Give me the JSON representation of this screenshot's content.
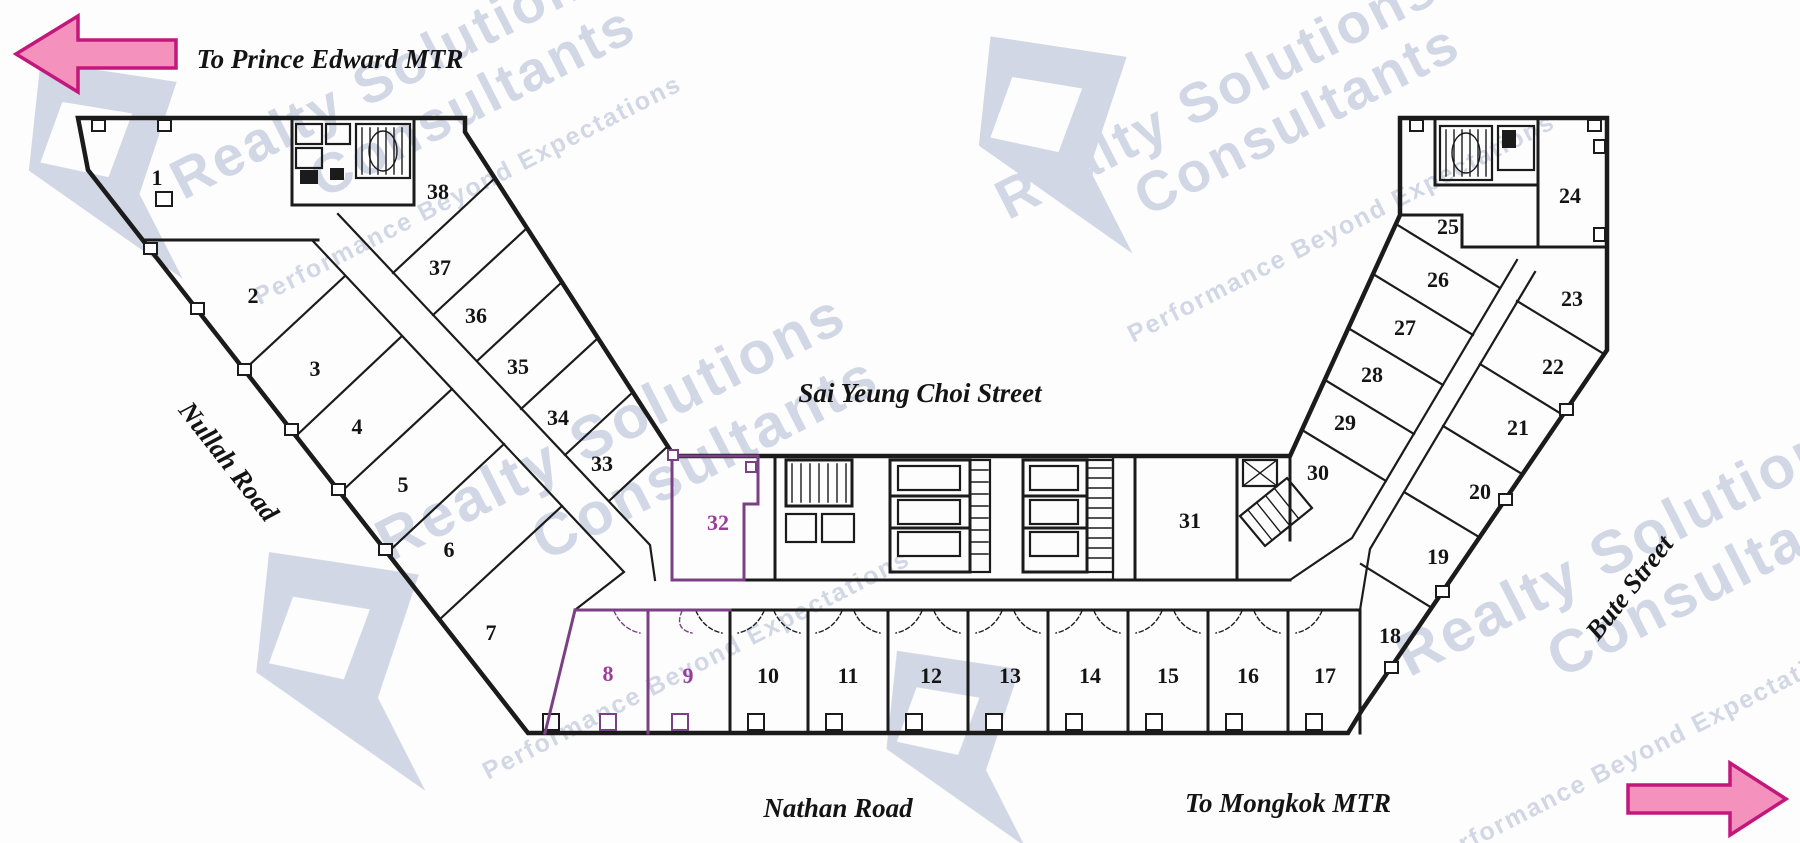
{
  "plan": {
    "direction_labels": {
      "west": "To Prince Edward MTR",
      "east": "To Mongkok MTR"
    },
    "street_labels": {
      "north_inner": "Sai Yeung Choi Street",
      "west": "Nullah Road",
      "south": "Nathan Road",
      "east": "Bute Street"
    },
    "units": {
      "1": "1",
      "2": "2",
      "3": "3",
      "4": "4",
      "5": "5",
      "6": "6",
      "7": "7",
      "8": "8",
      "9": "9",
      "10": "10",
      "11": "11",
      "12": "12",
      "13": "13",
      "14": "14",
      "15": "15",
      "16": "16",
      "17": "17",
      "18": "18",
      "19": "19",
      "20": "20",
      "21": "21",
      "22": "22",
      "23": "23",
      "24": "24",
      "25": "25",
      "26": "26",
      "27": "27",
      "28": "28",
      "29": "29",
      "30": "30",
      "31": "31",
      "32": "32",
      "33": "33",
      "34": "34",
      "35": "35",
      "36": "36",
      "37": "37",
      "38": "38"
    },
    "highlighted_units": [
      "8",
      "9",
      "32"
    ]
  },
  "watermark": {
    "brand_line1": "Realty Solutions",
    "brand_line2": "Consultants",
    "tagline": "Performance Beyond Expectations"
  },
  "colors": {
    "wall": "#1b1b1b",
    "highlight_wall": "#7a4084",
    "highlight_number": "#9a3d9a",
    "arrow_fill": "#f492bd",
    "arrow_outline": "#c2187c",
    "watermark": "#ccd3e2",
    "background": "#fdfdfd"
  }
}
